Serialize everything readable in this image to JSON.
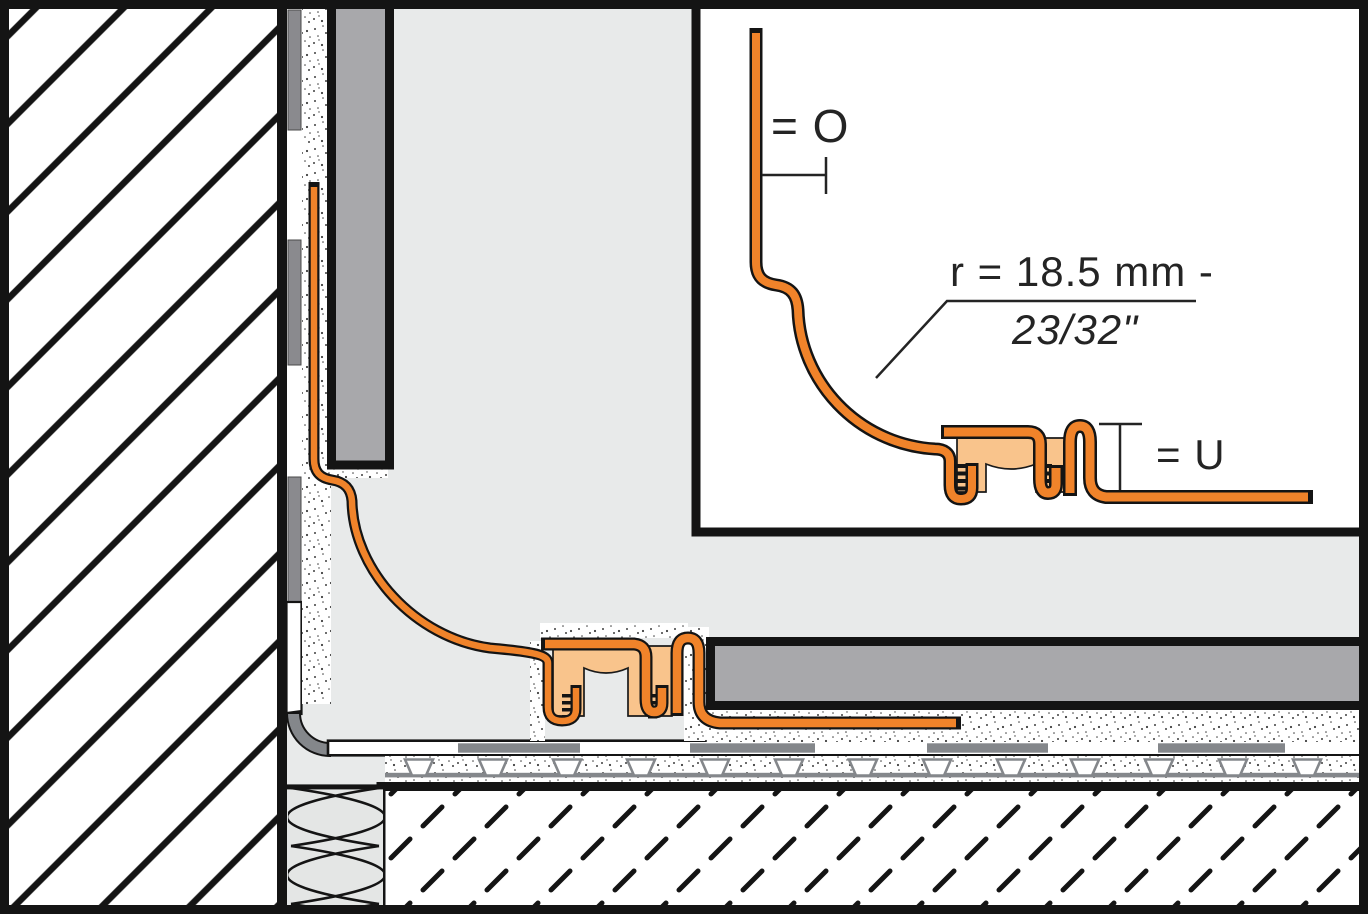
{
  "diagram": {
    "kind": "installation cross-section of a cove-shaped floor/wall transition profile",
    "inset_detail": {
      "dim_o_label": "= O",
      "radius_label_metric": "r = 18.5 mm -",
      "radius_label_imperial": "23/32\"",
      "dim_u_label": "= U"
    },
    "colors": {
      "profile_orange": "#F0832A",
      "profile_peach": "#F9C48C",
      "outline_black": "#141414",
      "tile_gray": "#A8A8AB",
      "membrane_gray": "#84878B",
      "thinset_bar_gray": "#8A8A8E",
      "room_gray": "#E8EAEA",
      "insulation_gray": "#E4E6E5",
      "paper_white": "#FFFFFF"
    }
  }
}
